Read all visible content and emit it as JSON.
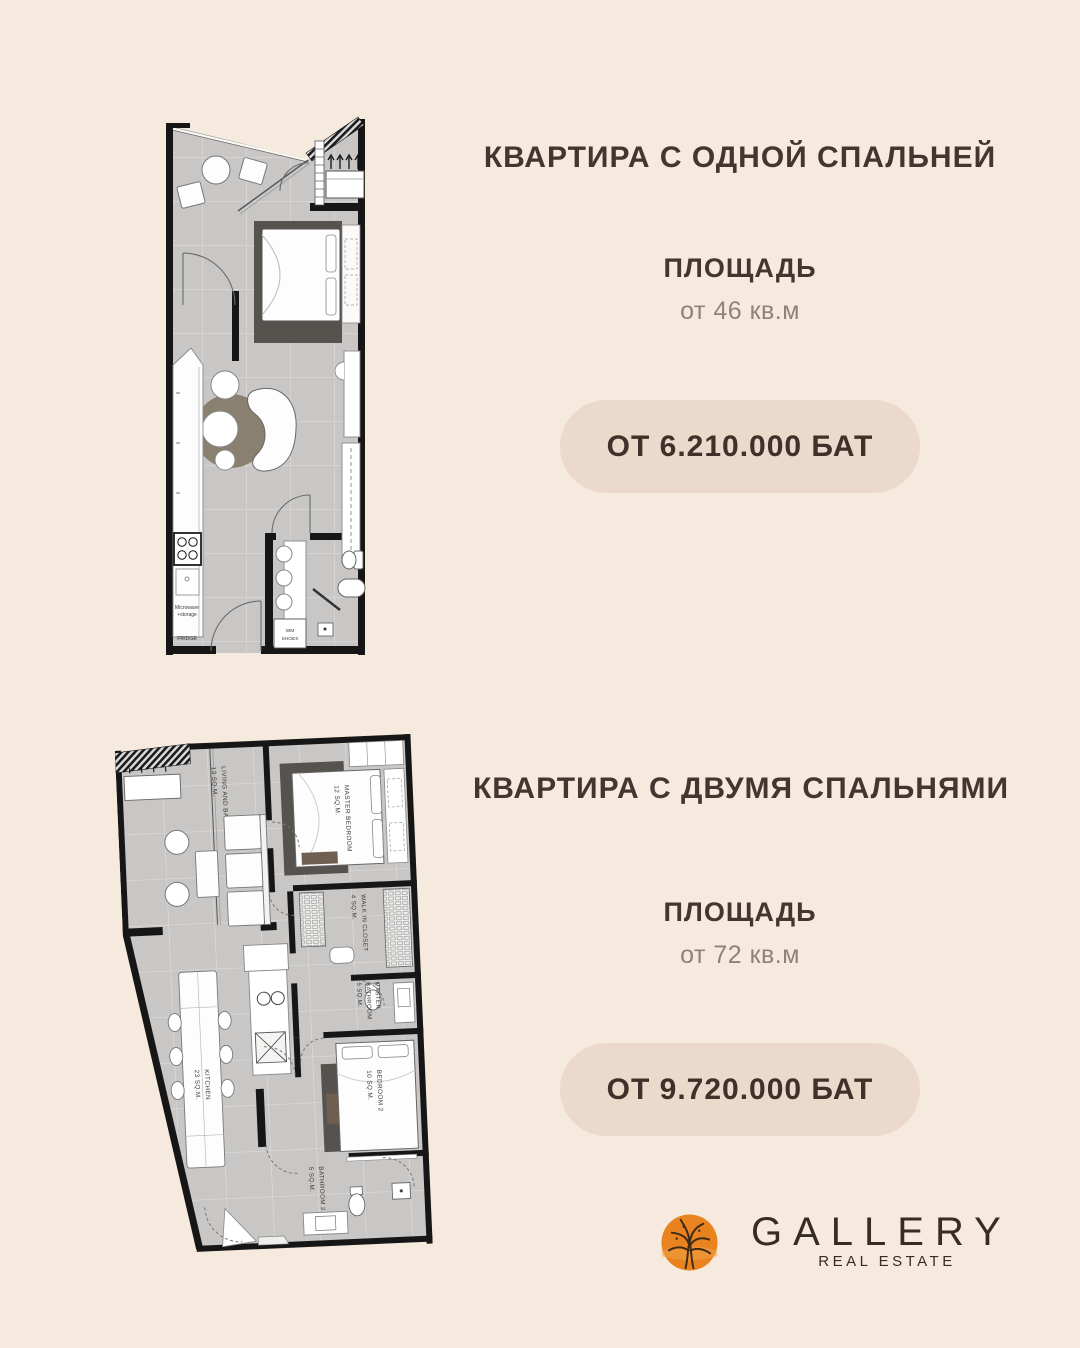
{
  "section_one": {
    "title": "КВАРТИРА С ОДНОЙ СПАЛЬНЕЙ",
    "area_label": "ПЛОЩАДЬ",
    "area_value": "от 46 кв.м",
    "price": "ОТ 6.210.000 БАТ"
  },
  "section_two": {
    "title": "КВАРТИРА С ДВУМЯ СПАЛЬНЯМИ",
    "area_label": "ПЛОЩАДЬ",
    "area_value": "от 72 кв.м",
    "price": "ОТ 9.720.000 БАТ"
  },
  "floorplan_one": {
    "labels": {
      "microwave_1": "Microwave",
      "microwave_2": "+storage",
      "fridge": "FRIDGE",
      "wm_1": "WM",
      "wm_2": "SHOES"
    }
  },
  "floorplan_two": {
    "labels": {
      "living_1": "LIVING AND BALCONY",
      "living_2": "13 SQ.M.",
      "master_bedroom_1": "MASTER BEDROOM",
      "master_bedroom_2": "12 SQ.M.",
      "closet_1": "WALK IN CLOSET",
      "closet_2": "4 SQ.M.",
      "master_bath_1": "MASTER",
      "master_bath_2": "BATHROOM",
      "master_bath_3": "5 SQ.M.",
      "kitchen_1": "KITCHEN",
      "kitchen_2": "23 SQ.M.",
      "bedroom2_1": "BEDROOM 2",
      "bedroom2_2": "10 SQ.M.",
      "bathroom2_1": "BATHROOM 2",
      "bathroom2_2": "5 SQ.M."
    }
  },
  "logo": {
    "brand": "GALLERY",
    "tagline": "REAL ESTATE"
  },
  "colors": {
    "background": "#f6e9dd",
    "heading": "#443530",
    "muted": "#8e8279",
    "pill_bg": "#ebd9cb",
    "pill_text": "#41302a",
    "plan_floor": "#c9c7c5",
    "plan_wall": "#161616",
    "rug_dark": "#56524d",
    "rug_round": "#89806f",
    "logo_orange": "#e8831f",
    "logo_text": "#362c25"
  }
}
